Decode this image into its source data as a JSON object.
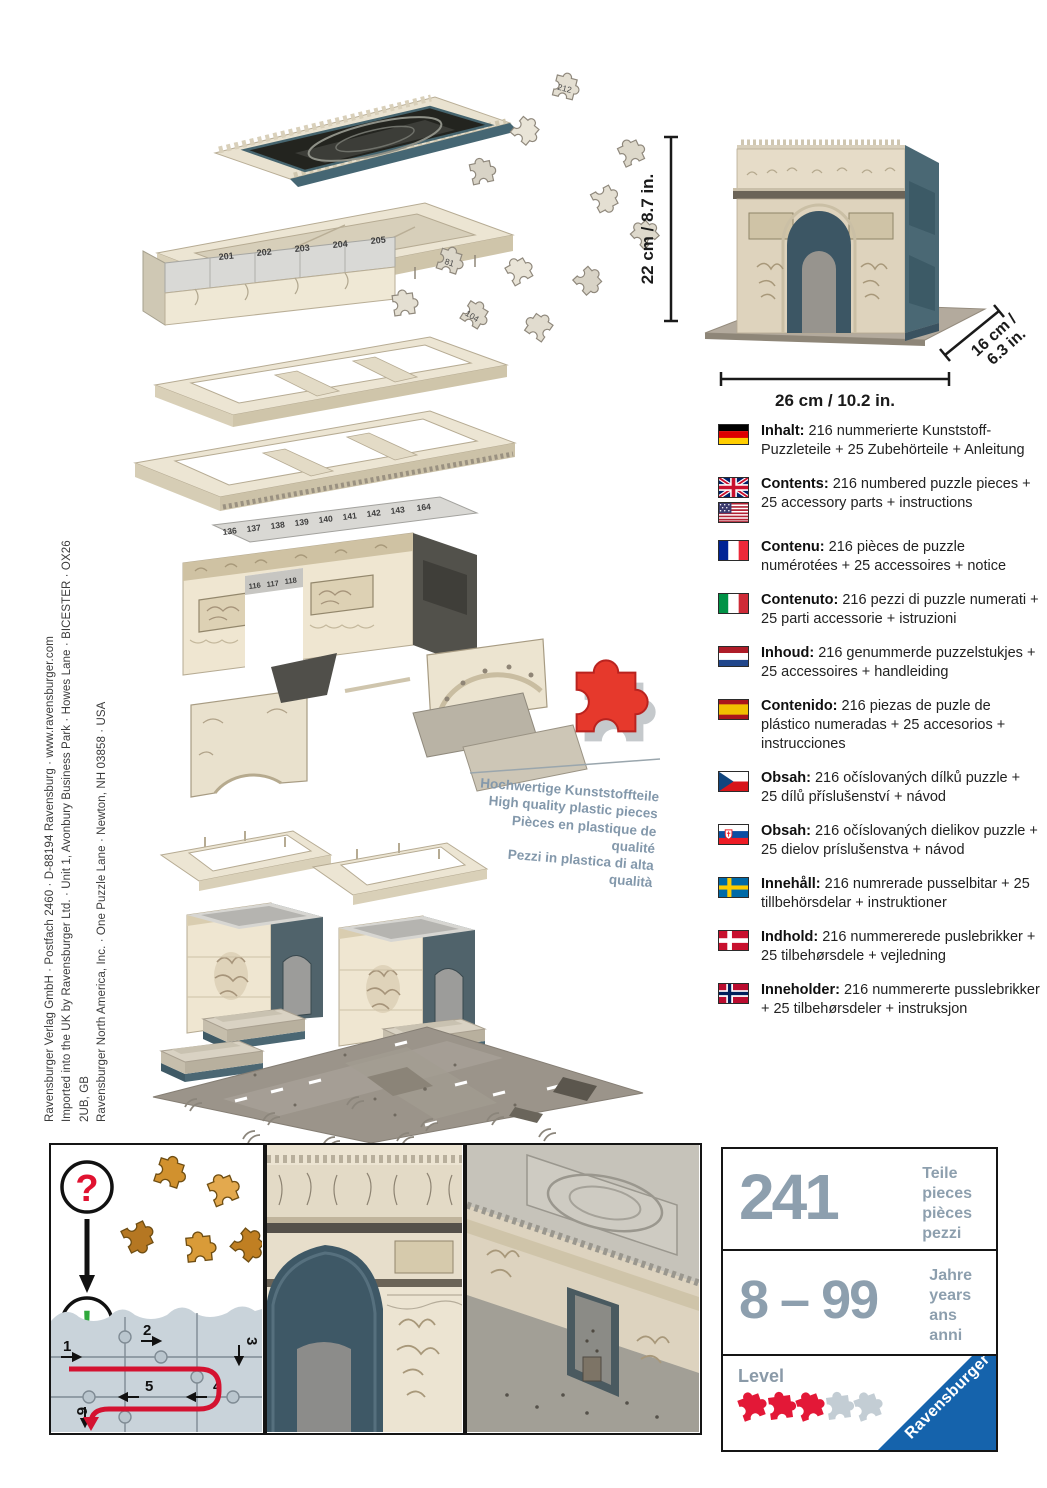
{
  "colophon": {
    "line1": "Ravensburger Verlag GmbH · Postfach 2460 · D-88194 Ravensburg · www.ravensburger.com",
    "line2": "Imported into the UK by Ravensburger Ltd. · Unit 1, Avonbury Business Park · Howes Lane · BICESTER · OX26 2UB, GB",
    "line3": "Ravensburger North America, Inc. · One Puzzle Lane · Newton, NH 03858 · USA"
  },
  "product": {
    "height_label": "22 cm / 8.7 in.",
    "width_label": "26 cm / 10.2 in.",
    "depth_label_line1": "16 cm /",
    "depth_label_line2": "6.3 in."
  },
  "quality_note": {
    "de": "Hochwertige Kunststoffteile",
    "en": "High quality plastic pieces",
    "fr": "Pièces en plastique de qualité",
    "it": "Pezzi in plastica di alta qualità"
  },
  "diagram": {
    "band_numbers": [
      "201",
      "202",
      "203",
      "204",
      "205"
    ],
    "attic_numbers": [
      "136",
      "137",
      "138",
      "139",
      "140",
      "141",
      "142",
      "143",
      "164"
    ],
    "inner_numbers": [
      "116",
      "117",
      "118"
    ],
    "piece_numbers": [
      "212",
      "81",
      "104"
    ]
  },
  "contents": {
    "entries": [
      {
        "flag": "germany",
        "label": "Inhalt:",
        "text": "216 nummerierte Kunststoff-Puzzleteile + 25 Zubehörteile + Anleitung"
      },
      {
        "flag": "uk-usa",
        "label": "Contents:",
        "text": "216 numbered puzzle pieces + 25 accessory parts + instructions"
      },
      {
        "flag": "france",
        "label": "Contenu:",
        "text": "216 pièces de puzzle numérotées + 25 accessoires + notice"
      },
      {
        "flag": "italy",
        "label": "Contenuto:",
        "text": "216 pezzi di puzzle numerati + 25 parti accessorie + istruzioni"
      },
      {
        "flag": "netherlands",
        "label": "Inhoud:",
        "text": "216 genummerde puzzelstukjes + 25 accessoires + handleiding"
      },
      {
        "flag": "spain",
        "label": "Contenido:",
        "text": "216 piezas de puzle de plástico numeradas + 25 accesorios + instrucciones"
      },
      {
        "flag": "czech-republic",
        "label": "Obsah:",
        "text": "216 očíslovaných dílků puzzle + 25 dílů příslušenství + návod"
      },
      {
        "flag": "slovakia",
        "label": "Obsah:",
        "text": "216 očíslovaných dielikov puzzle + 25 dielov príslušenstva + návod"
      },
      {
        "flag": "sweden",
        "label": "Innehåll:",
        "text": "216 numrerade pusselbitar + 25 tillbehörsdelar + instruktioner"
      },
      {
        "flag": "denmark",
        "label": "Indhold:",
        "text": "216 nummererede puslebrikker + 25 tilbehørsdele + vejledning"
      },
      {
        "flag": "norway",
        "label": "Inneholder:",
        "text": "216 nummererte pusslebrikker + 25 tilbehørsdeler + instruksjon"
      }
    ]
  },
  "howto": {
    "question_mark": "?",
    "exclamation_mark": "!",
    "steps": [
      "1",
      "2",
      "3",
      "4",
      "5",
      "6"
    ]
  },
  "infobox": {
    "pieces": {
      "value": "241",
      "labels": [
        "Teile",
        "pieces",
        "pièces",
        "pezzi"
      ]
    },
    "age": {
      "value": "8 – 99",
      "labels": [
        "Jahre",
        "years",
        "ans",
        "anni"
      ]
    },
    "level": {
      "label": "Level",
      "filled": 3,
      "total": 5
    },
    "brand": "Ravensburger"
  },
  "colors": {
    "accent_red": "#e31837",
    "level_gray": "#c3cdd4",
    "brand_blue": "#1563ac",
    "muted_blue": "#8d9fae",
    "cream": "#ece5d3",
    "teal": "#4a6874"
  }
}
